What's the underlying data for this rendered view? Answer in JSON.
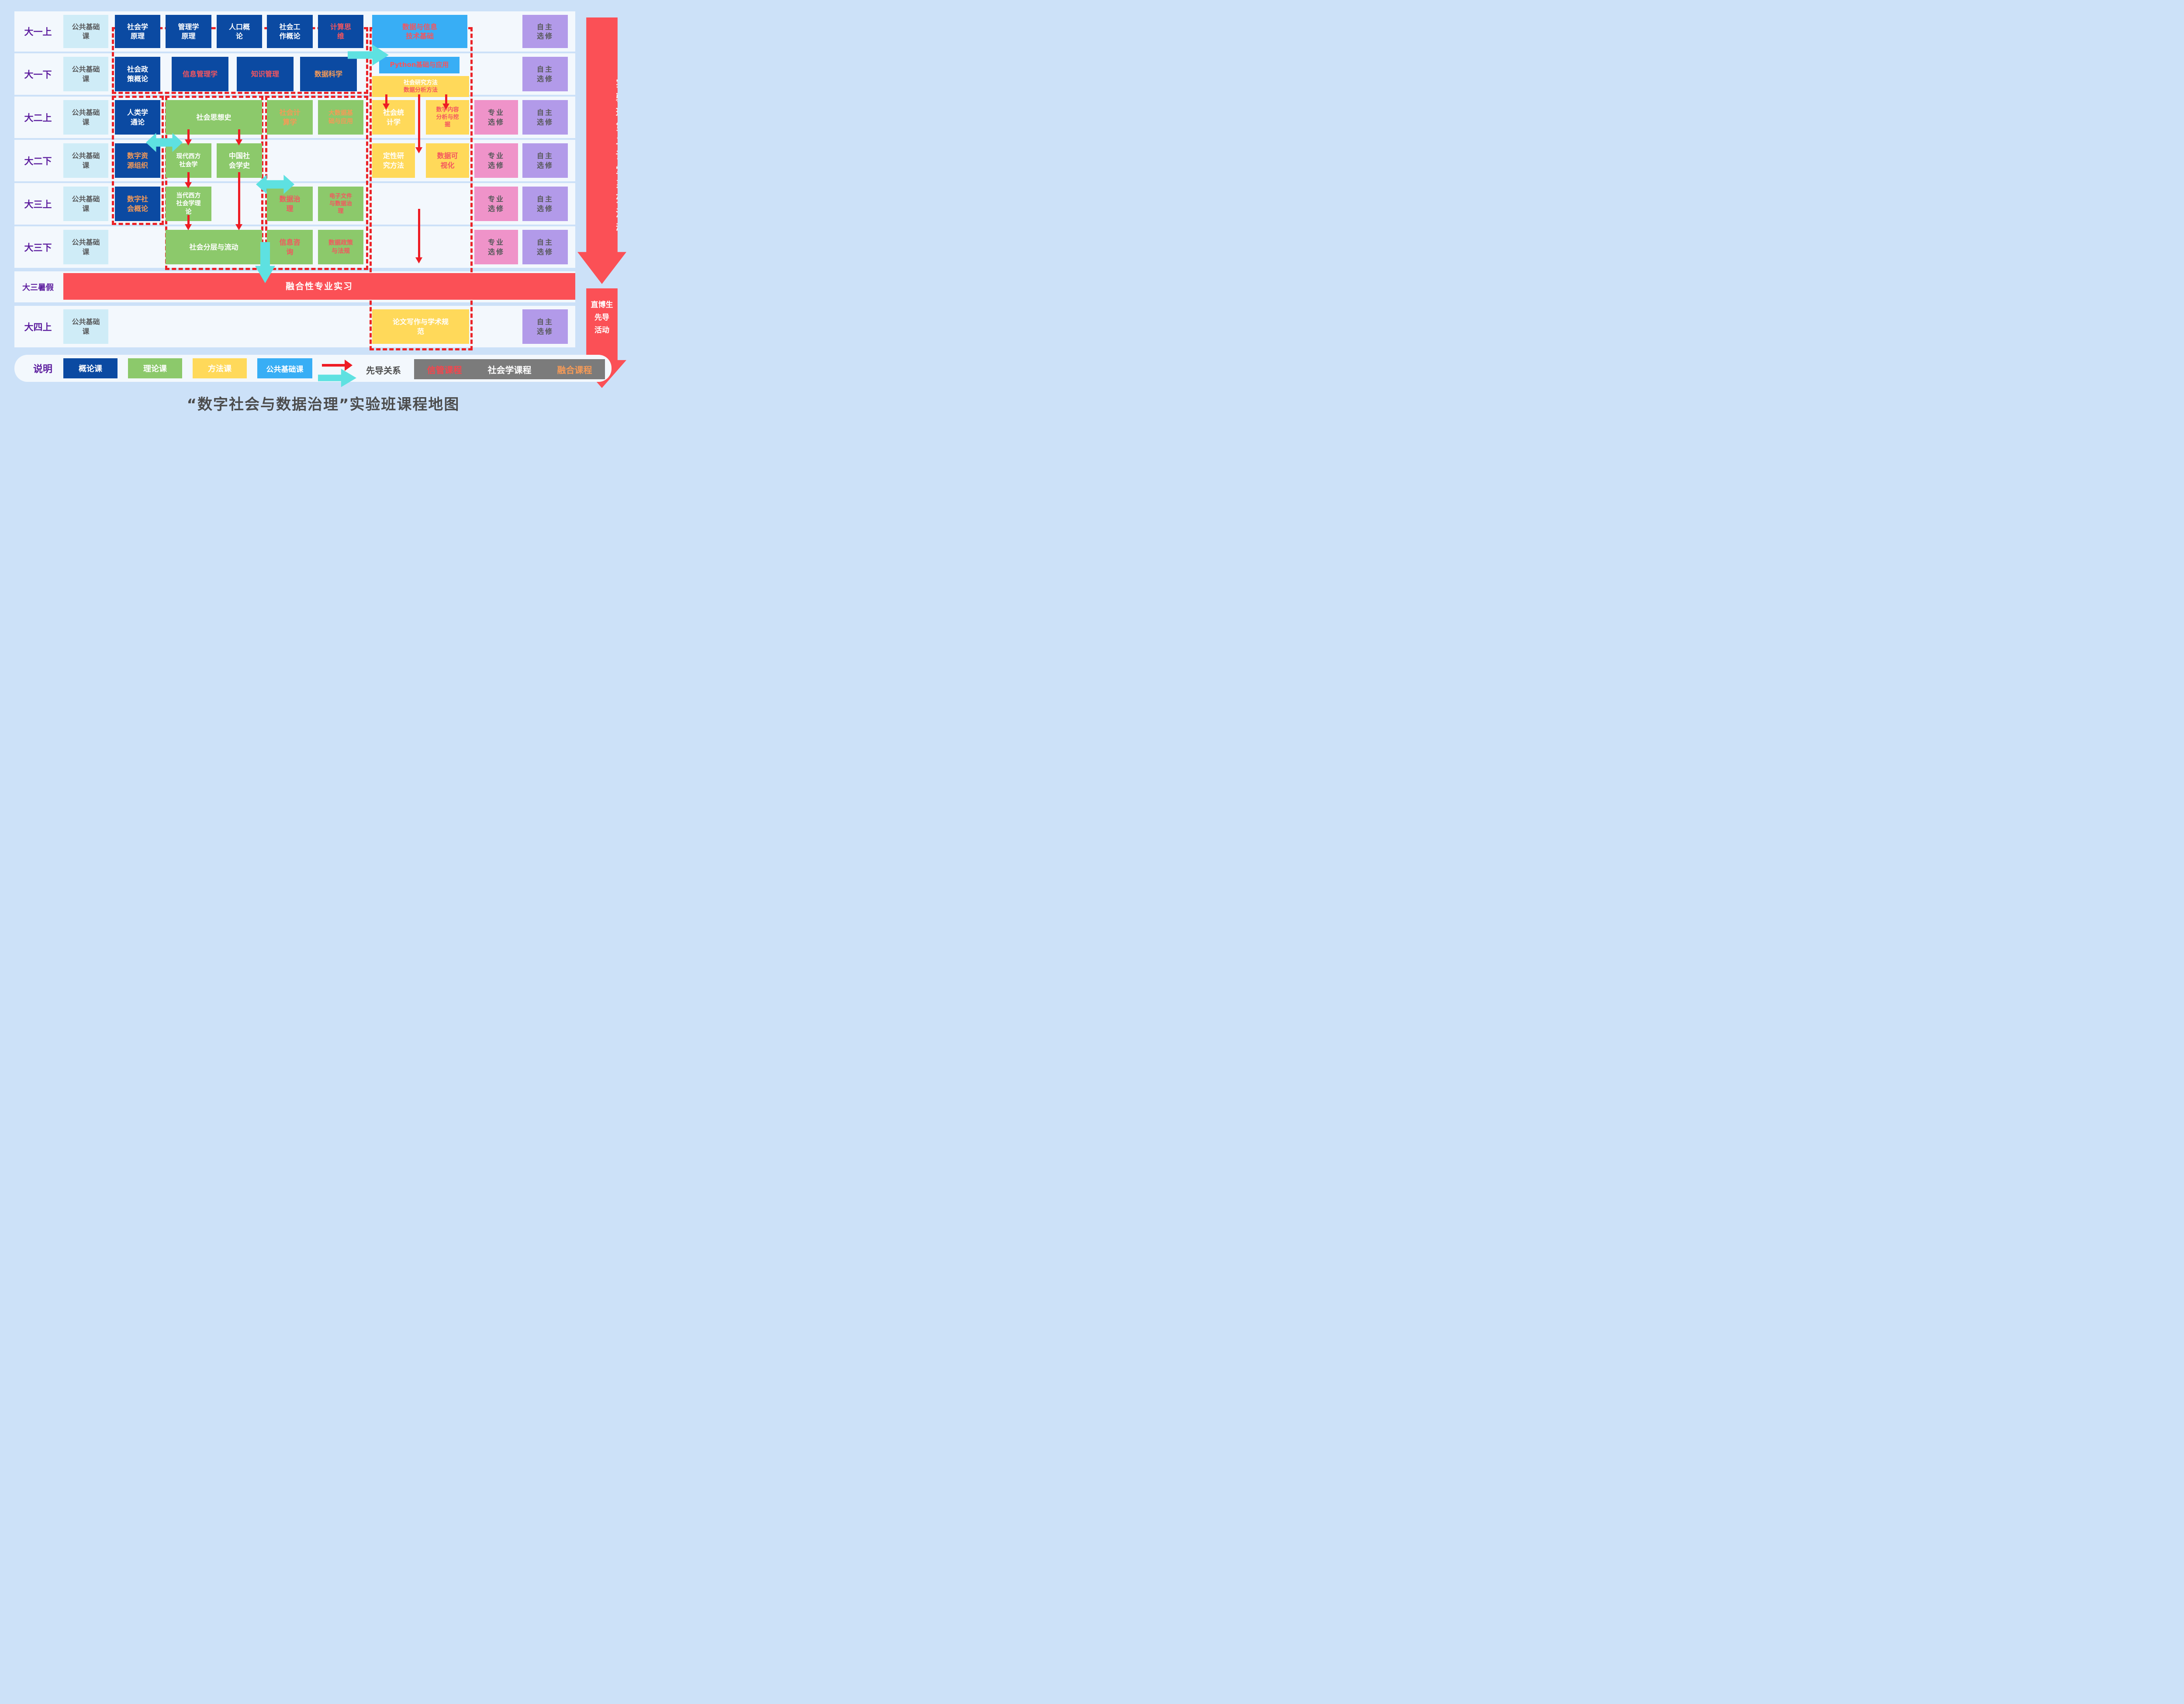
{
  "title": "“数字社会与数据治理”实验班课程地图",
  "side": {
    "banner1": "实验班第二课堂系列活动",
    "banner2": "直博生\n先导\n活动"
  },
  "band7_label": "融合性专业实习",
  "rows": [
    {
      "label": "大一上",
      "public": "公共基础\n课",
      "courses": [
        {
          "name": "社会学\n原理"
        },
        {
          "name": "管理学\n原理"
        },
        {
          "name": "人口概\n论"
        },
        {
          "name": "社会工\n作概论"
        },
        {
          "name": "计算思\n维"
        },
        {
          "name": "数据与信息\n技术基础"
        },
        {
          "name": "自主\n选修"
        }
      ]
    },
    {
      "label": "大一下",
      "public": "公共基础\n课",
      "courses": [
        {
          "name": "社会政\n策概论"
        },
        {
          "name": "信息管理学"
        },
        {
          "name": "知识管理"
        },
        {
          "name": "数据科学"
        },
        {
          "name": "Python基础与应用"
        },
        {
          "line1": "社会研究方法",
          "line2": "数据分析方法"
        },
        {
          "name": "自主\n选修"
        }
      ]
    },
    {
      "label": "大二上",
      "public": "公共基础\n课",
      "courses": [
        {
          "name": "人类学\n通论"
        },
        {
          "name": "社会思想史"
        },
        {
          "name": "社会计\n算学"
        },
        {
          "name": "大数据基\n础与应用"
        },
        {
          "name": "社会统\n计学"
        },
        {
          "name": "数字内容\n分析与挖\n掘"
        },
        {
          "name": "专业\n选修"
        },
        {
          "name": "自主\n选修"
        }
      ]
    },
    {
      "label": "大二下",
      "public": "公共基础\n课",
      "courses": [
        {
          "name": "数字资\n源组织"
        },
        {
          "name": "现代西方\n社会学"
        },
        {
          "name": "中国社\n会学史"
        },
        {
          "name": "定性研\n究方法"
        },
        {
          "name": "数据可\n视化"
        },
        {
          "name": "专业\n选修"
        },
        {
          "name": "自主\n选修"
        }
      ]
    },
    {
      "label": "大三上",
      "public": "公共基础\n课",
      "courses": [
        {
          "name": "数字社\n会概论"
        },
        {
          "name": "当代西方\n社会学理\n论"
        },
        {
          "name": "数据治\n理"
        },
        {
          "name": "电子文件\n与数据治\n理"
        },
        {
          "name": "专业\n选修"
        },
        {
          "name": "自主\n选修"
        }
      ]
    },
    {
      "label": "大三下",
      "public": "公共基础\n课",
      "courses": [
        {
          "name": "社会分层与流动"
        },
        {
          "name": "信息咨\n询"
        },
        {
          "name": "数据政策\n与法规"
        },
        {
          "name": "专业\n选修"
        },
        {
          "name": "自主\n选修"
        }
      ]
    },
    {
      "label": "大三暑假"
    },
    {
      "label": "大四上",
      "public": "公共基础\n课",
      "courses": [
        {
          "name": "论文写作与学术规\n范"
        },
        {
          "name": "自主\n选修"
        }
      ]
    }
  ],
  "legend": {
    "heading": "说明",
    "items": [
      {
        "label": "概论课"
      },
      {
        "label": "理论课"
      },
      {
        "label": "方法课"
      },
      {
        "label": "公共基础课"
      }
    ],
    "arrow_label": "先导关系",
    "course_tags": [
      {
        "label": "信管课程"
      },
      {
        "label": "社会学课程"
      },
      {
        "label": "融合课程"
      }
    ]
  }
}
